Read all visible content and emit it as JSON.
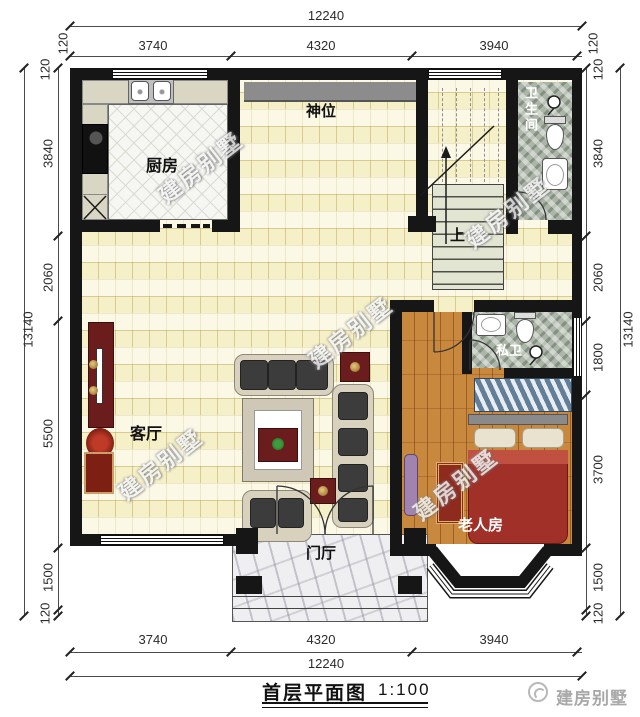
{
  "watermark": {
    "text": "建房别墅"
  },
  "rooms": {
    "kitchen": "厨房",
    "shrine": "神位",
    "bathroom": "卫生间",
    "living": "客厅",
    "private_bath": "私卫",
    "elder_room": "老人房",
    "foyer": "门厅",
    "stairs_up": "上"
  },
  "dims": {
    "top": {
      "total": "12240",
      "segs": [
        "3740",
        "4320",
        "3940"
      ],
      "end": "120"
    },
    "bottom": {
      "total": "12240",
      "segs": [
        "3740",
        "4320",
        "3940"
      ]
    },
    "left": {
      "total": "13140",
      "segs": [
        "120",
        "3840",
        "2060",
        "5500",
        "1500",
        "120"
      ]
    },
    "right": {
      "total": "13140",
      "segs": [
        "120",
        "3840",
        "2060",
        "1800",
        "3700",
        "1500",
        "120"
      ]
    }
  },
  "footer": {
    "title": "首层平面图",
    "scale": "1:100",
    "brand": "建房别墅"
  },
  "colors": {
    "wall": "#161616",
    "floor_tile": "#F6F0C8",
    "wood_floor": "#C8883E",
    "bath_marble": "#ACB6A8",
    "accent_red": "#6B1D1D"
  }
}
